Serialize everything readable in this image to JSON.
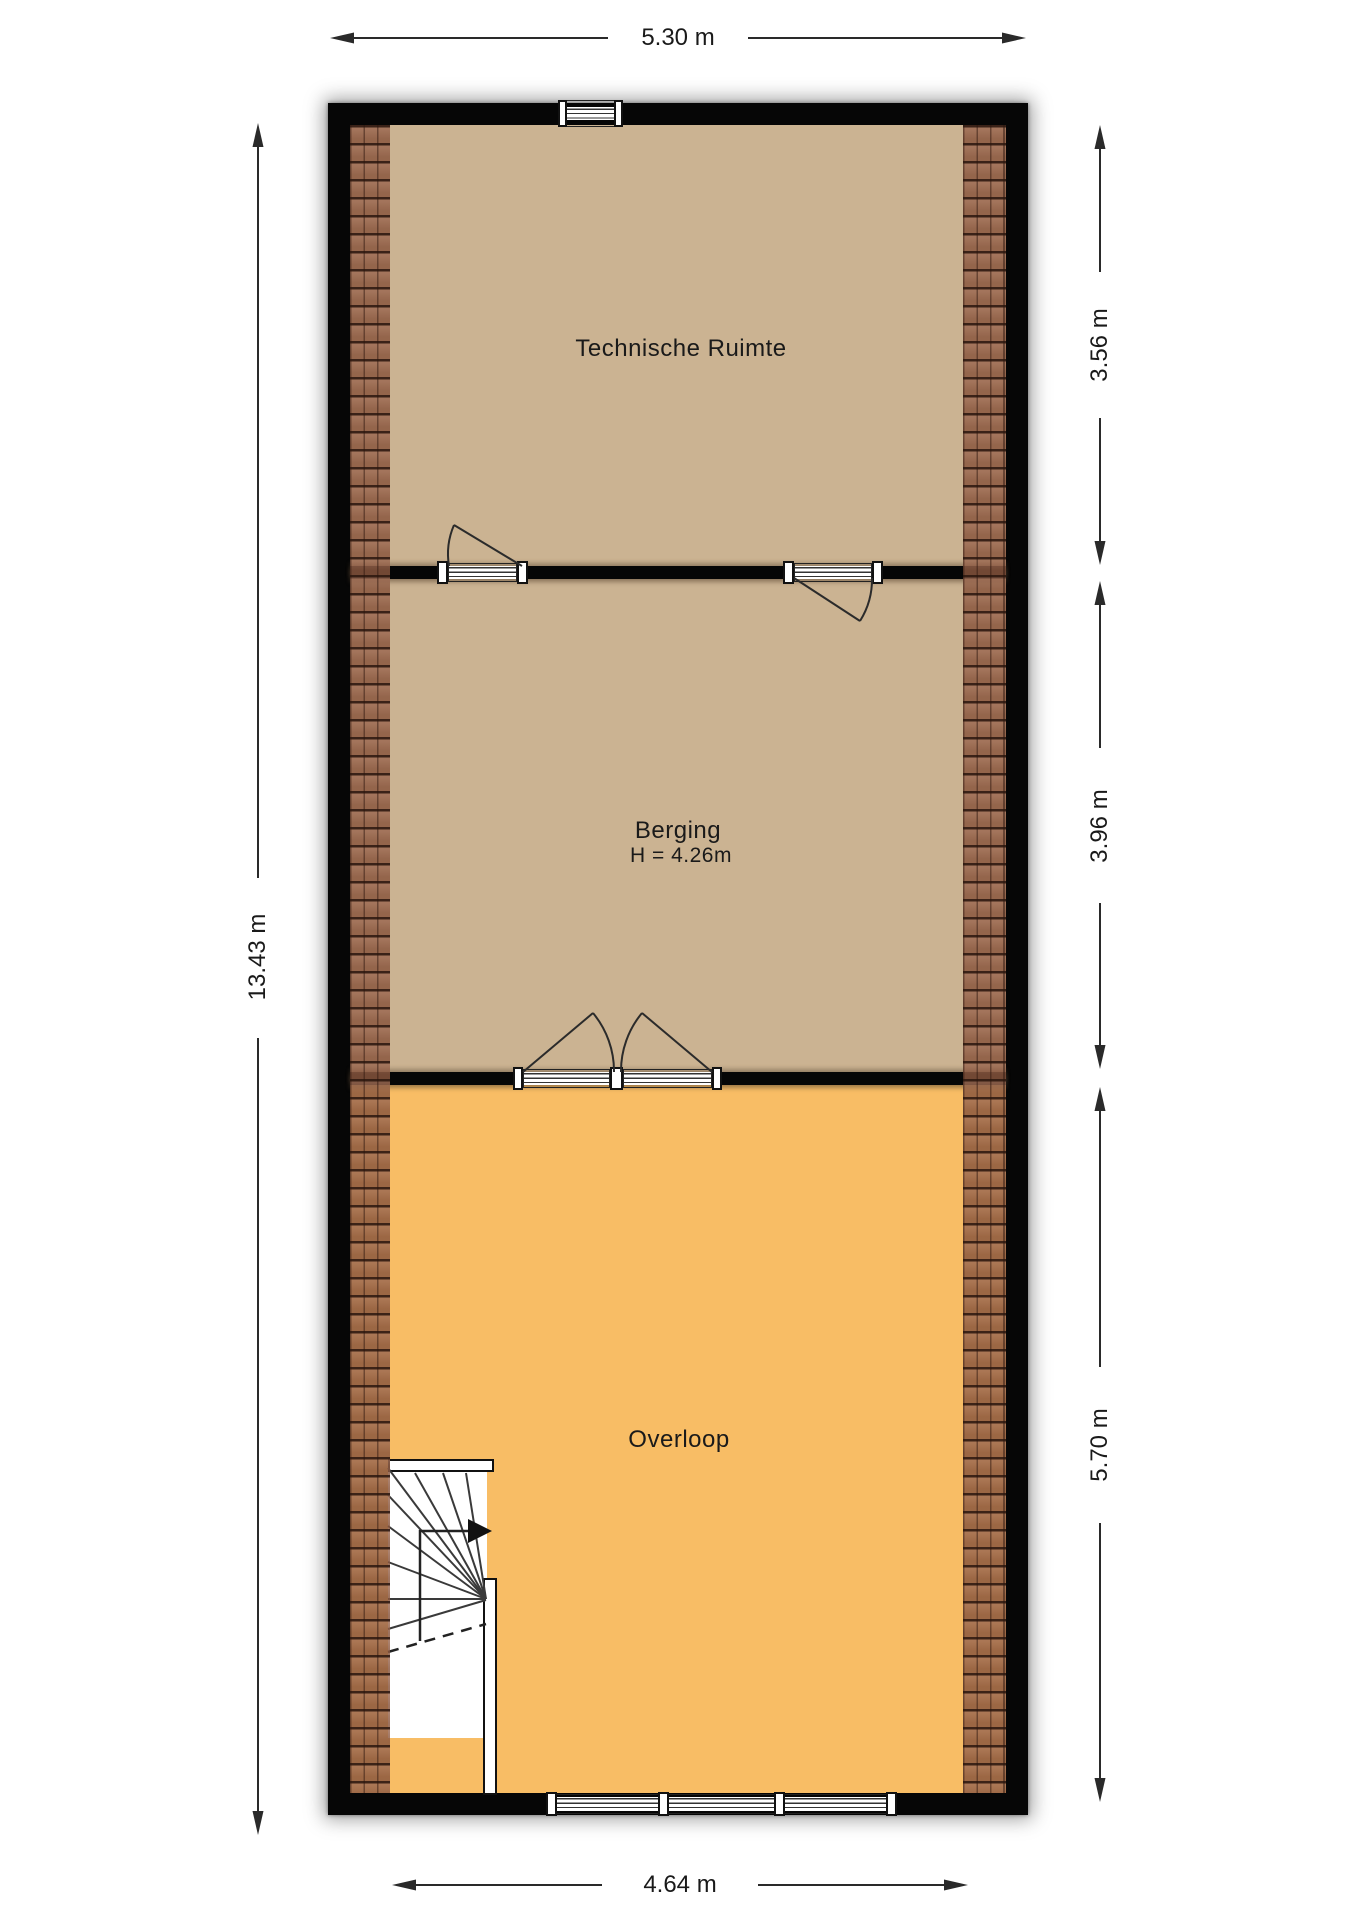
{
  "floor_plan": {
    "rooms": [
      {
        "name": "Technische Ruimte"
      },
      {
        "name": "Berging",
        "height_label": "H = 4.26m"
      },
      {
        "name": "Overloop"
      }
    ],
    "dimensions": {
      "top": "5.30 m",
      "left": "13.43 m",
      "bottom": "4.64 m",
      "right": [
        "3.56 m",
        "3.96 m",
        "5.70 m"
      ]
    },
    "colors": {
      "wall": "#060606",
      "floor_tan": "#cbb392",
      "floor_orange": "#f8bd65",
      "roof_tile": "#925c42",
      "dimension_line": "#2a2a2a"
    }
  }
}
